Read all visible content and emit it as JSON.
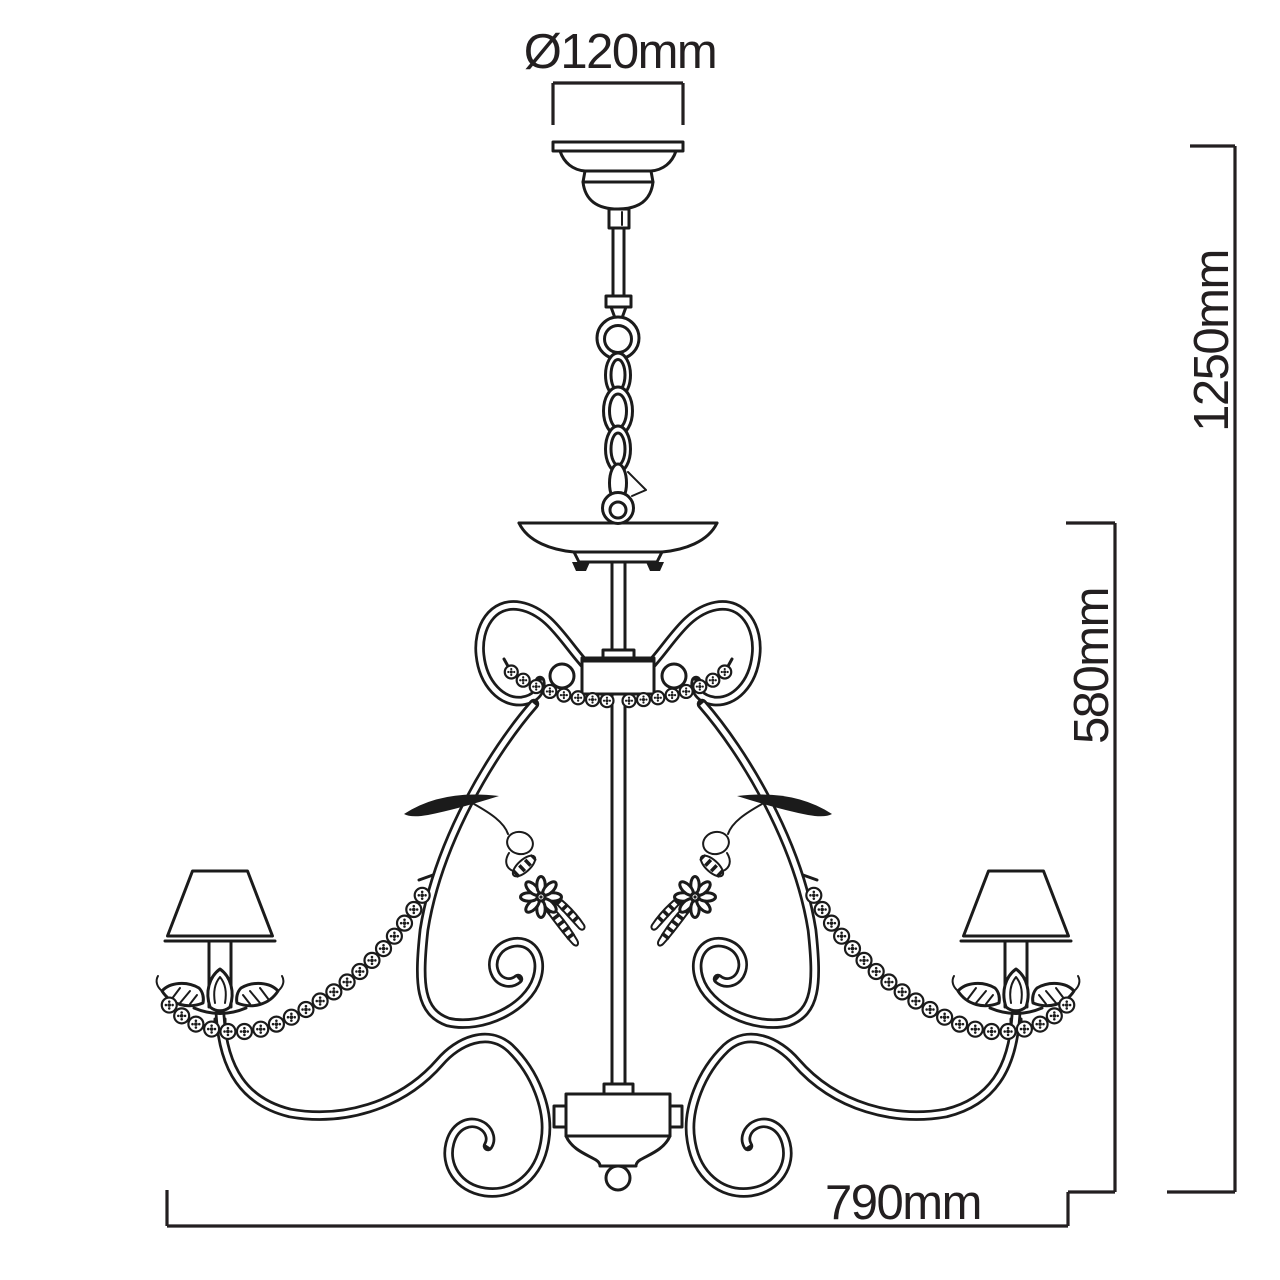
{
  "title": "Chandelier dimension drawing",
  "drawing": {
    "line_color": "#1b1b1b",
    "dimension_color": "#231f20",
    "background": "#ffffff"
  },
  "dimensions": {
    "canopy_diameter": "Ø120mm",
    "overall_height": "1250mm",
    "body_height": "580mm",
    "overall_width": "790mm"
  }
}
